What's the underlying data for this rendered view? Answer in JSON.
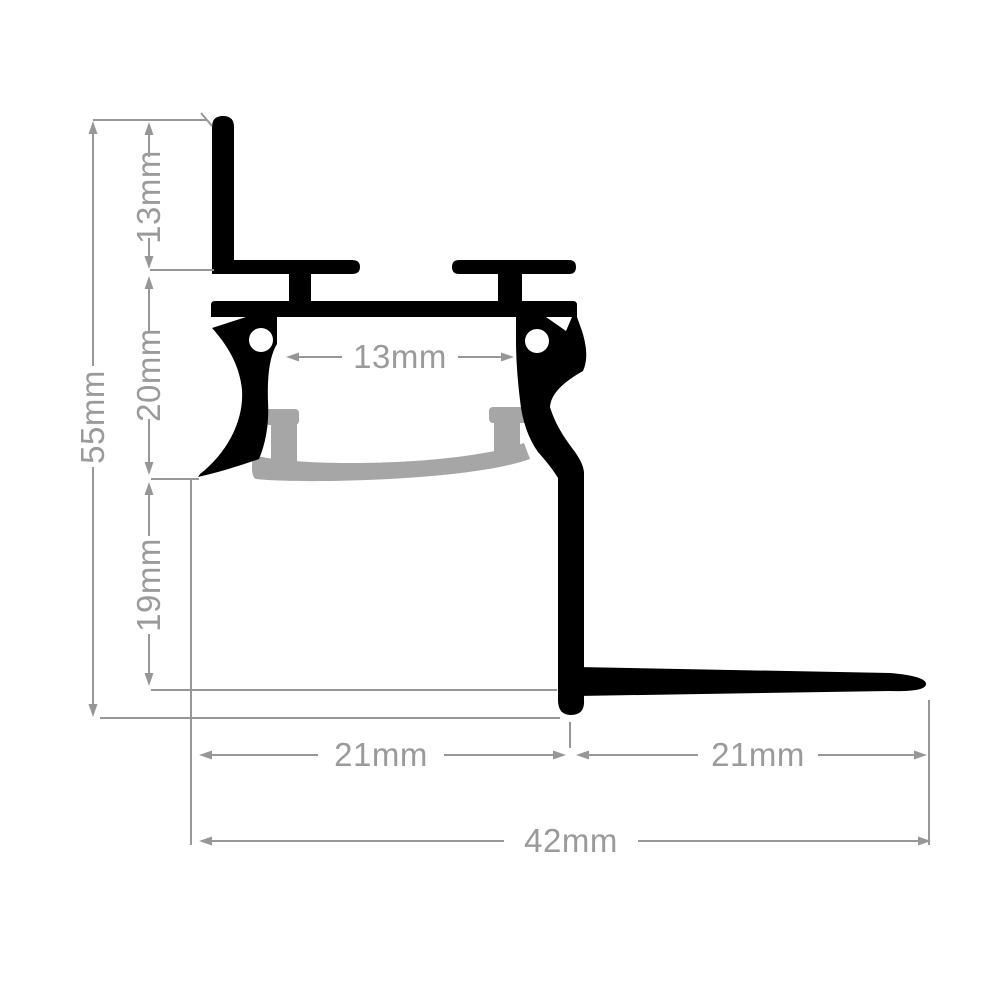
{
  "dimensions": {
    "fin_height": "13mm",
    "channel_height": "20mm",
    "recess_depth": "19mm",
    "overall_height": "55mm",
    "inner_width": "13mm",
    "left_width": "21mm",
    "right_width": "21mm",
    "overall_width": "42mm"
  },
  "colors": {
    "profile": "#000000",
    "diffuser": "#a6a6a6",
    "notch": "#ffffff",
    "dimension_line": "#979797",
    "dimension_text": "#9a9a9a",
    "background": "#ffffff"
  }
}
